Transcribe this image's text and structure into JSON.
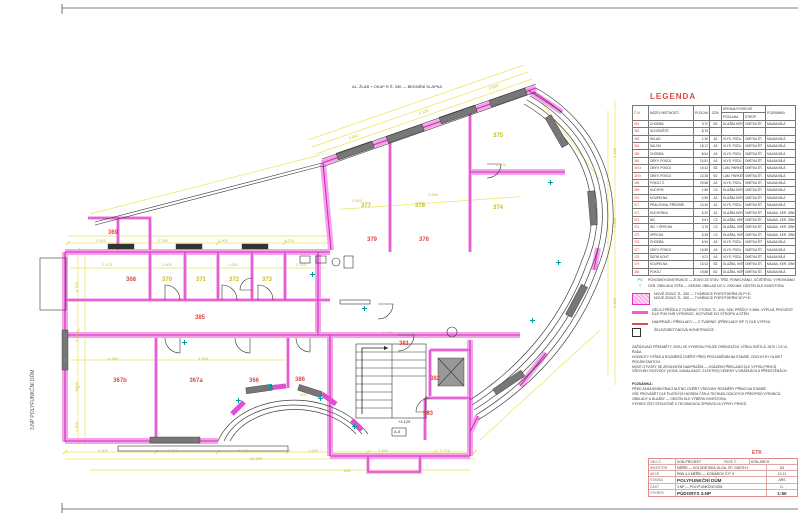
{
  "sheet": {
    "vertical_text": "3.NP  POLYFUNKČNÍ DŮM",
    "top_annotation": "AL. ŽLAB + OKAP R.Š. 330 — BEDNĚNÍ KLAPKA",
    "stair_note": "A-5",
    "level_note": "+4,125"
  },
  "legend": {
    "title": "LEGENDA",
    "headers": {
      "no": "Č.M.",
      "name": "NÁZEV MÍSTNOSTI",
      "area": "PLOCHA M²",
      "code": "OZN.",
      "surfaces": "ÚPRAVA POVRCHŮ",
      "floor": "PODLAHA",
      "ceil": "STROP",
      "note": "POZNÁMKA"
    },
    "rows": [
      {
        "n": "361",
        "name": "CHODBA",
        "area": "9,70",
        "code": "B2",
        "floor": "DLAŽBA KER.",
        "ceil": "OMÍTKA ŠT.",
        "note": "MALBA BÍLÁ"
      },
      {
        "n": "362",
        "name": "SCHODIŠTĚ",
        "area": "8,75",
        "code": "",
        "floor": "",
        "ceil": "",
        "note": ""
      },
      {
        "n": "363",
        "name": "SKLAD",
        "area": "1,30",
        "code": "A2",
        "floor": "VLYS. PODL. LAK",
        "ceil": "OMÍTKA ŠT.",
        "note": "MALBA BÍLÁ"
      },
      {
        "n": "364",
        "name": "SALON",
        "area": "18,17",
        "code": "A3",
        "floor": "VLYS. PODL. LAK",
        "ceil": "OMÍTKA ŠT.",
        "note": "MALBA BÍLÁ"
      },
      {
        "n": "365",
        "name": "CHODBA",
        "area": "8,04",
        "code": "A3",
        "floor": "VLYS. PODL. LAK",
        "ceil": "OMÍTKA ŠT.",
        "note": "MALBA BÍLÁ"
      },
      {
        "n": "366",
        "name": "OBÝV. POKOJ",
        "area": "24,81",
        "code": "A3",
        "floor": "VLYS. PODL. LAK",
        "ceil": "OMÍTKA ŠT.",
        "note": "MALBA BÍLÁ"
      },
      {
        "n": "367a",
        "name": "OBÝV. POKOJ",
        "area": "19,42",
        "code": "B2",
        "floor": "LAM. PARKETY, MIRELON",
        "ceil": "OMÍTKA ŠT.",
        "note": "MALBA BÍLÁ"
      },
      {
        "n": "367b",
        "name": "OBÝV. POKOJ",
        "area": "13,28",
        "code": "B2",
        "floor": "LAM. PARKETY, MIRELON",
        "ceil": "OMÍTKA ŠT.",
        "note": "MALBA BÍLÁ"
      },
      {
        "n": "368",
        "name": "POKOJ Č.",
        "area": "29,68",
        "code": "A3",
        "floor": "VLYS. PODL. LAK",
        "ceil": "OMÍTKA ŠT.",
        "note": "MALBA BÍLÁ"
      },
      {
        "n": "369",
        "name": "KUCHYŇ",
        "area": "1,85",
        "code": "C4",
        "floor": "DLAŽBA KER. + SOKL",
        "ceil": "OMÍTKA ŠT.",
        "note": "MALBA BÍLÁ"
      },
      {
        "n": "370",
        "name": "KOUPELNA",
        "area": "4,59",
        "code": "A3",
        "floor": "DLAŽBA KER.",
        "ceil": "OMÍTKA ŠT.",
        "note": "MALBA BÍLÁ"
      },
      {
        "n": "371",
        "name": "PRACOVNA, PŘEDSÍŇ",
        "area": "13,40",
        "code": "A3",
        "floor": "VLYS. PODL. LAK",
        "ceil": "OMÍTKA ŠT.",
        "note": "MALBA BÍLÁ"
      },
      {
        "n": "372",
        "name": "KUCHYŇKA",
        "area": "6,20",
        "code": "A3",
        "floor": "DLAŽBA KER.",
        "ceil": "OMÍTKA ŠT.",
        "note": "MALBA, KER. OBKLAD"
      },
      {
        "n": "373",
        "name": "WC",
        "area": "5,61",
        "code": "C3",
        "floor": "DLAŽBA, KER. OBKLAD V.200",
        "ceil": "OMÍTKA ŠT.",
        "note": "MALBA, KER. OBKLAD"
      },
      {
        "n": "374",
        "name": "WC + SPRCHA",
        "area": "3,76",
        "code": "C3",
        "floor": "DLAŽBA, KER. OBKLAD V.200",
        "ceil": "OMÍTKA ŠT.",
        "note": "MALBA, KER. OBKLAD"
      },
      {
        "n": "375",
        "name": "SPRCHA",
        "area": "5,35",
        "code": "C3",
        "floor": "DLAŽBA, KER. OBKLAD V.200",
        "ceil": "OMÍTKA ŠT.",
        "note": "MALBA, KER. OBKLAD"
      },
      {
        "n": "376",
        "name": "CHODBA",
        "area": "6,94",
        "code": "A3",
        "floor": "VLYS. PODL. LAK",
        "ceil": "OMÍTKA ŠT.",
        "note": "MALBA BÍLÁ"
      },
      {
        "n": "377",
        "name": "OBÝV. POKOJ",
        "area": "15,85",
        "code": "A3",
        "floor": "VLYS. PODL. LAK",
        "ceil": "OMÍTKA ŠT.",
        "note": "MALBA BÍLÁ"
      },
      {
        "n": "378",
        "name": "ŠATNÍ KOUT",
        "area": "9,21",
        "code": "A3",
        "floor": "VLYS. PODL. LAK",
        "ceil": "OMÍTKA ŠT.",
        "note": "MALBA BÍLÁ"
      },
      {
        "n": "379",
        "name": "KOUPELNA",
        "area": "15,03",
        "code": "B2",
        "floor": "DLAŽBA, KER. OBKLAD V.200",
        "ceil": "OMÍTKA ŠT.",
        "note": "MALBA, KER. OBKLAD"
      },
      {
        "n": "380",
        "name": "POKOJ",
        "area": "19,88",
        "code": "B2",
        "floor": "DLAŽBA, KER. OBKLAD V.200",
        "ceil": "OMÍTKA ŠT.",
        "note": "MALBA BÍLÁ"
      }
    ]
  },
  "top_notes": [
    {
      "code": "PV",
      "text": "PŮVODNÍ KONSTRUKCE — ZDIVO ZE STÁV. TŘÍD, PONECHÁNO, OČIŠTĚNO, VYROVNÁNO"
    },
    {
      "code": "T",
      "text": "OZN. OBKLADU STĚN — KERAM. OBKLAD DO V. 2000 MM, ODSTÍN DLE INVESTORA"
    }
  ],
  "wall_legend": [
    {
      "line1": "NOVÉ ZDIVO TL. 250 — TVÁRNICE POROTHERM 25 P+D",
      "line2": "NOVÉ ZDIVO TL. 300 — TVÁRNICE POROTHERM 30 P+D"
    },
    {
      "text": "DĚLICÍ PŘÍČKA Z TVÁRNIC YTONG TL. 100, SDK PŘÍČKY S MIN. VÝPLNÍ, PROVÉST DLE POKYNŮ VÝROBCE, KOTVENÉ DO STROPU A STĚN"
    },
    {
      "text": "NADPRAŽÍ / PŘEKLADY — Z TVÁRNIC (PŘEKLADY RP 7) DLE VÝPISU"
    },
    {
      "text": "ŽELEZOBETONOVÁ KONSTRUKCE"
    }
  ],
  "notes": {
    "lines": [
      "ZAŘIZOVACÍ PŘEDMĚTY JSOU VE VÝKRESU POUZE ORIENTAČNÍ.          VÝŠKA SVĚTLÁ: 2670 / 2,5 VL. ŘADA",
      "HODNOTY VÝŠEK A ROZMĚRŮ OVĚŘIT PŘED PROVÁDĚNÍM NA STAVBĚ, ODCHYLKY HLÁSIT PROJEKTANTOVI.",
      "NOVÉ OTVORY SE ZESÍLENÝM NADPRAŽÍM — OSAZENÍ PŘEKLADŮ DLE VÝPISU PRVKŮ.",
      "VŠECHNY ROZVODY (VODA, KANALIZACE, ELEKTRO) VEDENY V DRÁŽKÁCH A PŘEDSTĚNÁCH."
    ]
  },
  "poznamka": {
    "title": "POZNÁMKA:",
    "lines": [
      "PŘED ZAHÁJENÍM PRACÍ NUTNO OVĚŘIT VŠECHNY ROZMĚRY PŘÍMO NA STAVBĚ.",
      "VŠE PROVÁDĚT DLE PLATNÝCH NOREM ČSN A TECHNOLOGICKÝCH PŘEDPISŮ VÝROBCŮ.",
      "OBKLADY A DLAŽBY — ODSTÍN DLE VÝBĚRU INVESTORA.",
      "VÝKRES ČÍST SPOLEČNĚ S TECHNICKOU ZPRÁVOU A VÝPISY PRVKŮ."
    ]
  },
  "title_block": {
    "etk": "ETK",
    "header": {
      "l": "OBJ. Č.",
      "a": "KON-PROJEKT",
      "b": "PARÉ Č.",
      "c": "KON-ARCH"
    },
    "rows": [
      {
        "l": "INVESTOR",
        "v": "MĚŘÍK — KOLODĚJSKÁ OLGA, ČP. 2487/9 H."
      },
      {
        "l": "AKCE",
        "v": "RNS 4.4  MĚŘÍK — KOMÁROV Č.P. 9"
      },
      {
        "l": "STAVBA",
        "v": "POLYFUNKČNÍ DŮM"
      },
      {
        "l": "ČÁST",
        "v": "3.NP — POLYFUNKČNÍ DŮM"
      }
    ],
    "drawing": {
      "l": "VÝKRES",
      "v": "PŮDORYS 3.NP",
      "scale": "1:50"
    },
    "side": {
      "format": "A3",
      "date": "10 11",
      "stage": "ARS",
      "num": "D."
    }
  },
  "plan": {
    "rooms": [
      {
        "t": "377",
        "x": 366,
        "y": 206,
        "c": "y"
      },
      {
        "t": "378",
        "x": 420,
        "y": 206,
        "c": "y"
      },
      {
        "t": "375",
        "x": 498,
        "y": 136,
        "c": "y"
      },
      {
        "t": "374",
        "x": 498,
        "y": 208,
        "c": "y"
      },
      {
        "t": "379",
        "x": 372,
        "y": 240,
        "c": "r"
      },
      {
        "t": "376",
        "x": 424,
        "y": 240,
        "c": "r"
      },
      {
        "t": "369",
        "x": 113,
        "y": 233,
        "c": "r"
      },
      {
        "t": "368",
        "x": 131,
        "y": 280,
        "c": "r"
      },
      {
        "t": "370",
        "x": 167,
        "y": 280,
        "c": "y"
      },
      {
        "t": "371",
        "x": 201,
        "y": 280,
        "c": "y"
      },
      {
        "t": "372",
        "x": 234,
        "y": 280,
        "c": "y"
      },
      {
        "t": "373",
        "x": 267,
        "y": 280,
        "c": "y"
      },
      {
        "t": "385",
        "x": 200,
        "y": 318,
        "c": "r"
      },
      {
        "t": "367b",
        "x": 120,
        "y": 381,
        "c": "r"
      },
      {
        "t": "367a",
        "x": 196,
        "y": 381,
        "c": "r"
      },
      {
        "t": "366",
        "x": 254,
        "y": 381,
        "c": "r"
      },
      {
        "t": "386",
        "x": 300,
        "y": 380,
        "c": "r"
      },
      {
        "t": "381",
        "x": 404,
        "y": 344,
        "c": "r"
      },
      {
        "t": "382",
        "x": 435,
        "y": 379,
        "c": "r"
      },
      {
        "t": "383",
        "x": 428,
        "y": 414,
        "c": "r"
      }
    ],
    "dims": [
      {
        "t": "3 500",
        "x": 96,
        "y": 238,
        "r": 0
      },
      {
        "t": "2 250",
        "x": 158,
        "y": 238,
        "r": 0
      },
      {
        "t": "1 900",
        "x": 218,
        "y": 238,
        "r": 0
      },
      {
        "t": "4 275",
        "x": 284,
        "y": 238,
        "r": 0
      },
      {
        "t": "2 900",
        "x": 98,
        "y": 448,
        "r": 0
      },
      {
        "t": "3 600",
        "x": 168,
        "y": 448,
        "r": 0
      },
      {
        "t": "5 125",
        "x": 238,
        "y": 448,
        "r": 0
      },
      {
        "t": "1 500",
        "x": 308,
        "y": 448,
        "r": 0
      },
      {
        "t": "2 450",
        "x": 378,
        "y": 448,
        "r": 0
      },
      {
        "t": "3 775",
        "x": 440,
        "y": 448,
        "r": 0
      },
      {
        "t": "24 500",
        "x": 250,
        "y": 456,
        "r": 0
      },
      {
        "t": "4 750",
        "x": 74,
        "y": 292,
        "r": -90
      },
      {
        "t": "3 350",
        "x": 74,
        "y": 342,
        "r": -90
      },
      {
        "t": "2 900",
        "x": 74,
        "y": 392,
        "r": -90
      },
      {
        "t": "1 250",
        "x": 74,
        "y": 432,
        "r": -90
      },
      {
        "t": "3 950",
        "x": 348,
        "y": 136,
        "r": -19
      },
      {
        "t": "4 125",
        "x": 418,
        "y": 111,
        "r": -19
      },
      {
        "t": "3 600",
        "x": 488,
        "y": 86,
        "r": -19
      },
      {
        "t": "2 250",
        "x": 612,
        "y": 158,
        "r": -90
      },
      {
        "t": "4 900",
        "x": 612,
        "y": 228,
        "r": -90
      },
      {
        "t": "3 150",
        "x": 612,
        "y": 308,
        "r": -90
      },
      {
        "t": "2 475",
        "x": 102,
        "y": 262,
        "r": 0
      },
      {
        "t": "1 800",
        "x": 162,
        "y": 262,
        "r": 0
      },
      {
        "t": "1 650",
        "x": 228,
        "y": 262,
        "r": 0
      },
      {
        "t": "2 100",
        "x": 296,
        "y": 262,
        "r": 0
      },
      {
        "t": "4 350",
        "x": 108,
        "y": 356,
        "r": 0
      },
      {
        "t": "3 925",
        "x": 198,
        "y": 356,
        "r": 0
      },
      {
        "t": "3 500",
        "x": 352,
        "y": 198,
        "r": 0
      },
      {
        "t": "2 850",
        "x": 428,
        "y": 192,
        "r": 0
      },
      {
        "t": "2 600",
        "x": 496,
        "y": 162,
        "r": 0
      },
      {
        "t": "1 970",
        "x": 382,
        "y": 330,
        "r": 0
      },
      {
        "t": "900",
        "x": 300,
        "y": 392,
        "r": 0
      },
      {
        "t": "650",
        "x": 344,
        "y": 468,
        "r": 0
      }
    ],
    "teal": [
      {
        "x": 236,
        "y": 398
      },
      {
        "x": 268,
        "y": 384
      },
      {
        "x": 318,
        "y": 396
      },
      {
        "x": 352,
        "y": 424
      },
      {
        "x": 530,
        "y": 318
      },
      {
        "x": 556,
        "y": 260
      },
      {
        "x": 548,
        "y": 180
      },
      {
        "x": 310,
        "y": 272
      },
      {
        "x": 182,
        "y": 340
      },
      {
        "x": 362,
        "y": 306
      }
    ]
  }
}
